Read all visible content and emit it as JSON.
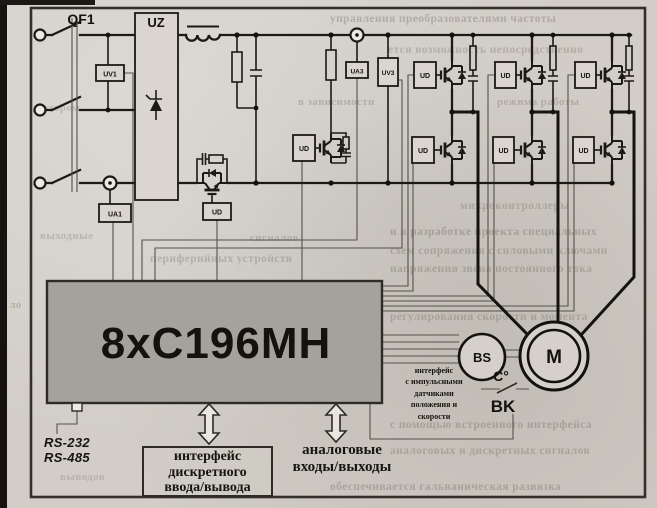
{
  "labels": {
    "breaker": "QF1",
    "rectifier": "UZ",
    "uv1": "UV1",
    "ua1": "UA1",
    "ua3": "UA3",
    "uv3": "UV3",
    "ud": "UD",
    "mcu": "8xC196MH",
    "rs232": "RS-232",
    "rs485": "RS-485",
    "speed_sensor": "BS",
    "motor": "M",
    "temp_deg": "C°",
    "thermal_sensor": "BK"
  },
  "texts": {
    "discrete_io": [
      "интерфейс",
      "дискретного",
      "ввода/вывода"
    ],
    "analog_io": [
      "аналоговые",
      "входы/выходы"
    ],
    "pulse_iface": [
      "интерфейс",
      "с импульсными",
      "датчиками",
      "положения и",
      "скорости"
    ]
  },
  "colors": {
    "paper": "#d2cec7",
    "ink": "#1c1a16",
    "mcu_fill": "#a5a29b",
    "control_line": "#55524a"
  },
  "bleedthrough": [
    {
      "x": 330,
      "y": 13,
      "w": 305,
      "fs": 11.5,
      "o": 0.3,
      "t": "управления преобразователями частоты"
    },
    {
      "x": 388,
      "y": 44,
      "w": 245,
      "fs": 11.5,
      "o": 0.27,
      "t": "ется возможность непосредственно"
    },
    {
      "x": 298,
      "y": 96,
      "w": 118,
      "fs": 11,
      "o": 0.28,
      "t": "в зависимости"
    },
    {
      "x": 497,
      "y": 96,
      "w": 140,
      "fs": 11,
      "o": 0.28,
      "t": "режима работы"
    },
    {
      "x": 36,
      "y": 102,
      "w": 58,
      "fs": 11,
      "o": 0.24,
      "t": "котором"
    },
    {
      "x": 460,
      "y": 200,
      "w": 175,
      "fs": 11.5,
      "o": 0.28,
      "t": "микроконтроллеры"
    },
    {
      "x": 40,
      "y": 230,
      "w": 88,
      "fs": 11,
      "o": 0.25,
      "t": "выходные"
    },
    {
      "x": 250,
      "y": 232,
      "w": 118,
      "fs": 11,
      "o": 0.27,
      "t": "сигналов"
    },
    {
      "x": 390,
      "y": 226,
      "w": 247,
      "fs": 11.5,
      "o": 0.33,
      "t": "и в разработке проекта специальных"
    },
    {
      "x": 390,
      "y": 245,
      "w": 247,
      "fs": 11.5,
      "o": 0.29,
      "t": "схем сопряжения с силовыми ключами"
    },
    {
      "x": 390,
      "y": 263,
      "w": 247,
      "fs": 11.5,
      "o": 0.29,
      "t": "напряжения звена постоянного тока"
    },
    {
      "x": 150,
      "y": 253,
      "w": 200,
      "fs": 11.5,
      "o": 0.28,
      "t": "периферийных устройств"
    },
    {
      "x": 390,
      "y": 311,
      "w": 250,
      "fs": 11.5,
      "o": 0.29,
      "t": "регулирования скорости и момента"
    },
    {
      "x": 390,
      "y": 419,
      "w": 250,
      "fs": 11.5,
      "o": 0.31,
      "t": "с помощью встроенного интерфейса"
    },
    {
      "x": 390,
      "y": 445,
      "w": 250,
      "fs": 11.5,
      "o": 0.29,
      "t": "аналоговых и дискретных сигналов"
    },
    {
      "x": 60,
      "y": 471,
      "w": 70,
      "fs": 11,
      "o": 0.24,
      "t": "выводов"
    },
    {
      "x": 330,
      "y": 481,
      "w": 300,
      "fs": 11.5,
      "o": 0.31,
      "t": "обеспечивается гальваническая развязка"
    },
    {
      "x": 10,
      "y": 300,
      "w": 18,
      "fs": 10,
      "o": 0.3,
      "t": "ло"
    }
  ]
}
